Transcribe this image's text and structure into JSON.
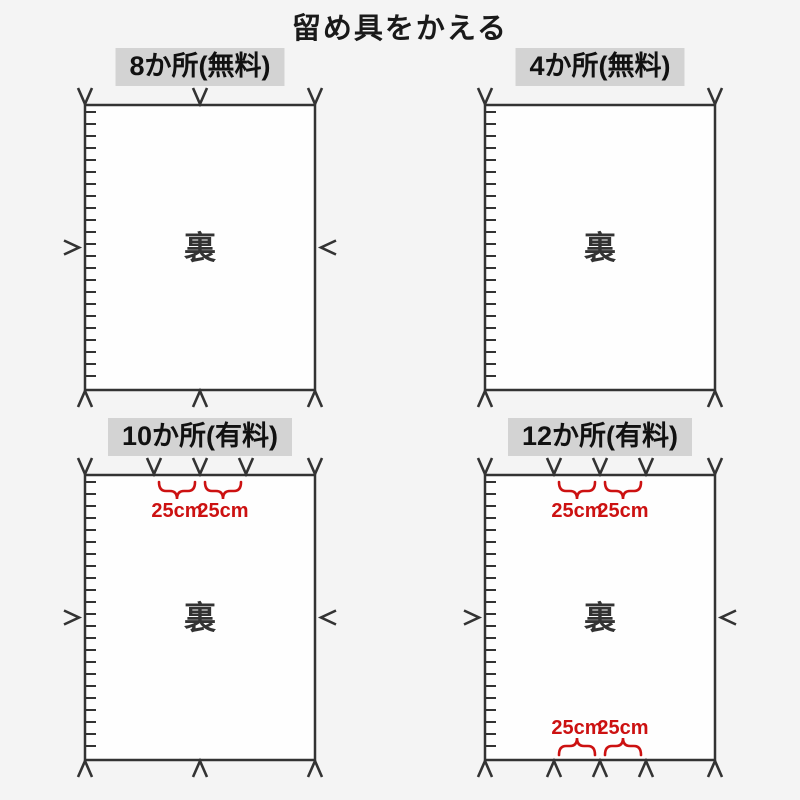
{
  "page": {
    "title": "留め具をかえる",
    "background": "#f4f4f4"
  },
  "colors": {
    "text": "#1a1a1a",
    "mark": "#333333",
    "panel_label_bg": "#d3d3d3",
    "rect_fill": "#fefefe",
    "rect_border": "#333333",
    "accent_red": "#cc1111"
  },
  "panels": [
    {
      "label": "8か所(無料)",
      "center_text": "裏",
      "top_marks_pct": [
        0,
        50,
        100
      ],
      "bottom_marks_pct": [
        0,
        50,
        100
      ],
      "left_mark": true,
      "right_mark": true,
      "zipper_left": true,
      "top_braces": [],
      "bottom_braces": []
    },
    {
      "label": "4か所(無料)",
      "center_text": "裏",
      "top_marks_pct": [
        0,
        100
      ],
      "bottom_marks_pct": [
        0,
        100
      ],
      "left_mark": false,
      "right_mark": false,
      "zipper_left": true,
      "top_braces": [],
      "bottom_braces": []
    },
    {
      "label": "10か所(有料)",
      "center_text": "裏",
      "top_marks_pct": [
        0,
        30,
        50,
        70,
        100
      ],
      "bottom_marks_pct": [
        0,
        50,
        100
      ],
      "left_mark": true,
      "right_mark": true,
      "zipper_left": true,
      "top_braces": [
        {
          "from_pct": 30,
          "to_pct": 50,
          "label": "25cm"
        },
        {
          "from_pct": 50,
          "to_pct": 70,
          "label": "25cm"
        }
      ],
      "bottom_braces": []
    },
    {
      "label": "12か所(有料)",
      "center_text": "裏",
      "top_marks_pct": [
        0,
        30,
        50,
        70,
        100
      ],
      "bottom_marks_pct": [
        0,
        30,
        50,
        70,
        100
      ],
      "left_mark": true,
      "right_mark": true,
      "zipper_left": true,
      "top_braces": [
        {
          "from_pct": 30,
          "to_pct": 50,
          "label": "25cm"
        },
        {
          "from_pct": 50,
          "to_pct": 70,
          "label": "25cm"
        }
      ],
      "bottom_braces": [
        {
          "from_pct": 30,
          "to_pct": 50,
          "label": "25cm"
        },
        {
          "from_pct": 50,
          "to_pct": 70,
          "label": "25cm"
        }
      ]
    }
  ]
}
